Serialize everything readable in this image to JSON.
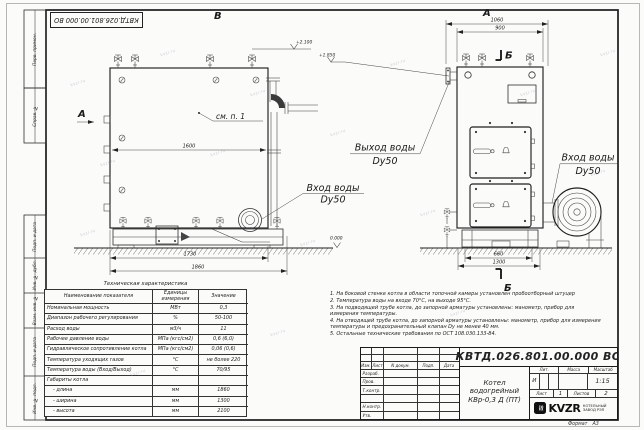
{
  "title_block": {
    "designation": "КВТД.026.801.00.000 ВО",
    "product_line1": "Котел водогрейный",
    "product_line2": "КВр-0,3 Д (ПТ)",
    "header_cols": {
      "izm": "Изм.",
      "list": "Лист",
      "doc": "N докум.",
      "sign": "Подп.",
      "date": "Дата"
    },
    "roles": [
      "Разраб.",
      "Пров.",
      "Т.контр.",
      "",
      "Н.контр.",
      "Утв."
    ],
    "lit_label": "Лит.",
    "lit_value": "И",
    "mass_label": "Масса",
    "scale_label": "Масштаб",
    "scale_value": "1:15",
    "sheet_label": "Лист",
    "sheet_value": "1",
    "sheets_label": "Листов",
    "sheets_value": "2",
    "company_logo": "KVZR",
    "company_line1": "КОТЕЛЬНЫЙ",
    "company_line2": "ЗАВОД РЭП",
    "format_label": "Формат",
    "format_value": "А3"
  },
  "margin_labels": [
    "Перв. примен.",
    "Справ. №",
    "Подп. и дата",
    "Инв. № дубл.",
    "Взам. инв. №",
    "Подп. и дата",
    "Инв. № подл."
  ],
  "views": {
    "left": {
      "top_view_letter": "В",
      "view_arrow": "А",
      "callout": "см. п. 1",
      "dims": {
        "width_inner": "1600",
        "base": "1730",
        "overall": "1860"
      },
      "elevations": {
        "top": "+2.100",
        "outlet": "+1.850",
        "ground": "0.000"
      },
      "inlet": {
        "line1": "Вход воды",
        "line2": "Dy50"
      }
    },
    "right": {
      "view_letter": "А",
      "section_letter": "Б",
      "dims": {
        "overall": "1060",
        "body": "900",
        "base": "660",
        "width": "1300"
      },
      "outlet": {
        "line1": "Выход воды",
        "line2": "Dy50"
      },
      "inlet": {
        "line1": "Вход воды",
        "line2": "Dy50"
      }
    }
  },
  "notes": [
    "1. На боковой стенке котла в области топочной камеры установлен пробоотборный штуцер",
    "2. Температура воды на входе 70°С, на выходе 95°С.",
    "3. На подводящей трубе котла, до запорной арматуры установлены: манометр, прибор для измерения температуры.",
    "4. На отводящей трубе котла, до запорной арматуры установлены: манометр, прибор для измерения температуры и предохранительный клапан Dy не менее 40 мм.",
    "5. Остальные технические требования по ОСТ 108.030.133-84."
  ],
  "tech_table": {
    "title": "Техническая характеристика",
    "headers": [
      "Наименование показателя",
      "Единицы измерения",
      "Значение"
    ],
    "rows": [
      [
        "Номинальная мощность",
        "МВт",
        "0,3"
      ],
      [
        "Диапазон рабочего регулирования",
        "%",
        "50-100"
      ],
      [
        "Расход воды",
        "м3/ч",
        "11"
      ],
      [
        "Рабочее давление воды",
        "МПа (кгс/см2)",
        "0,6 (6,0)"
      ],
      [
        "Гидравлическое сопротивление котла",
        "МПа (кгс/см2)",
        "0,06 (0,6)"
      ],
      [
        "Температура уходящих газов",
        "°С",
        "не более 220"
      ],
      [
        "Температура воды (Вход/Выход)",
        "°С",
        "70/95"
      ],
      [
        "Габариты котла",
        "",
        ""
      ],
      [
        "- длина",
        "мм",
        "1860"
      ],
      [
        "- ширина",
        "мм",
        "1300"
      ],
      [
        "- высота",
        "мм",
        "2100"
      ]
    ]
  },
  "icons": {
    "logo_wave": "≋"
  },
  "watermark": {
    "text": "kvzr.ru"
  }
}
